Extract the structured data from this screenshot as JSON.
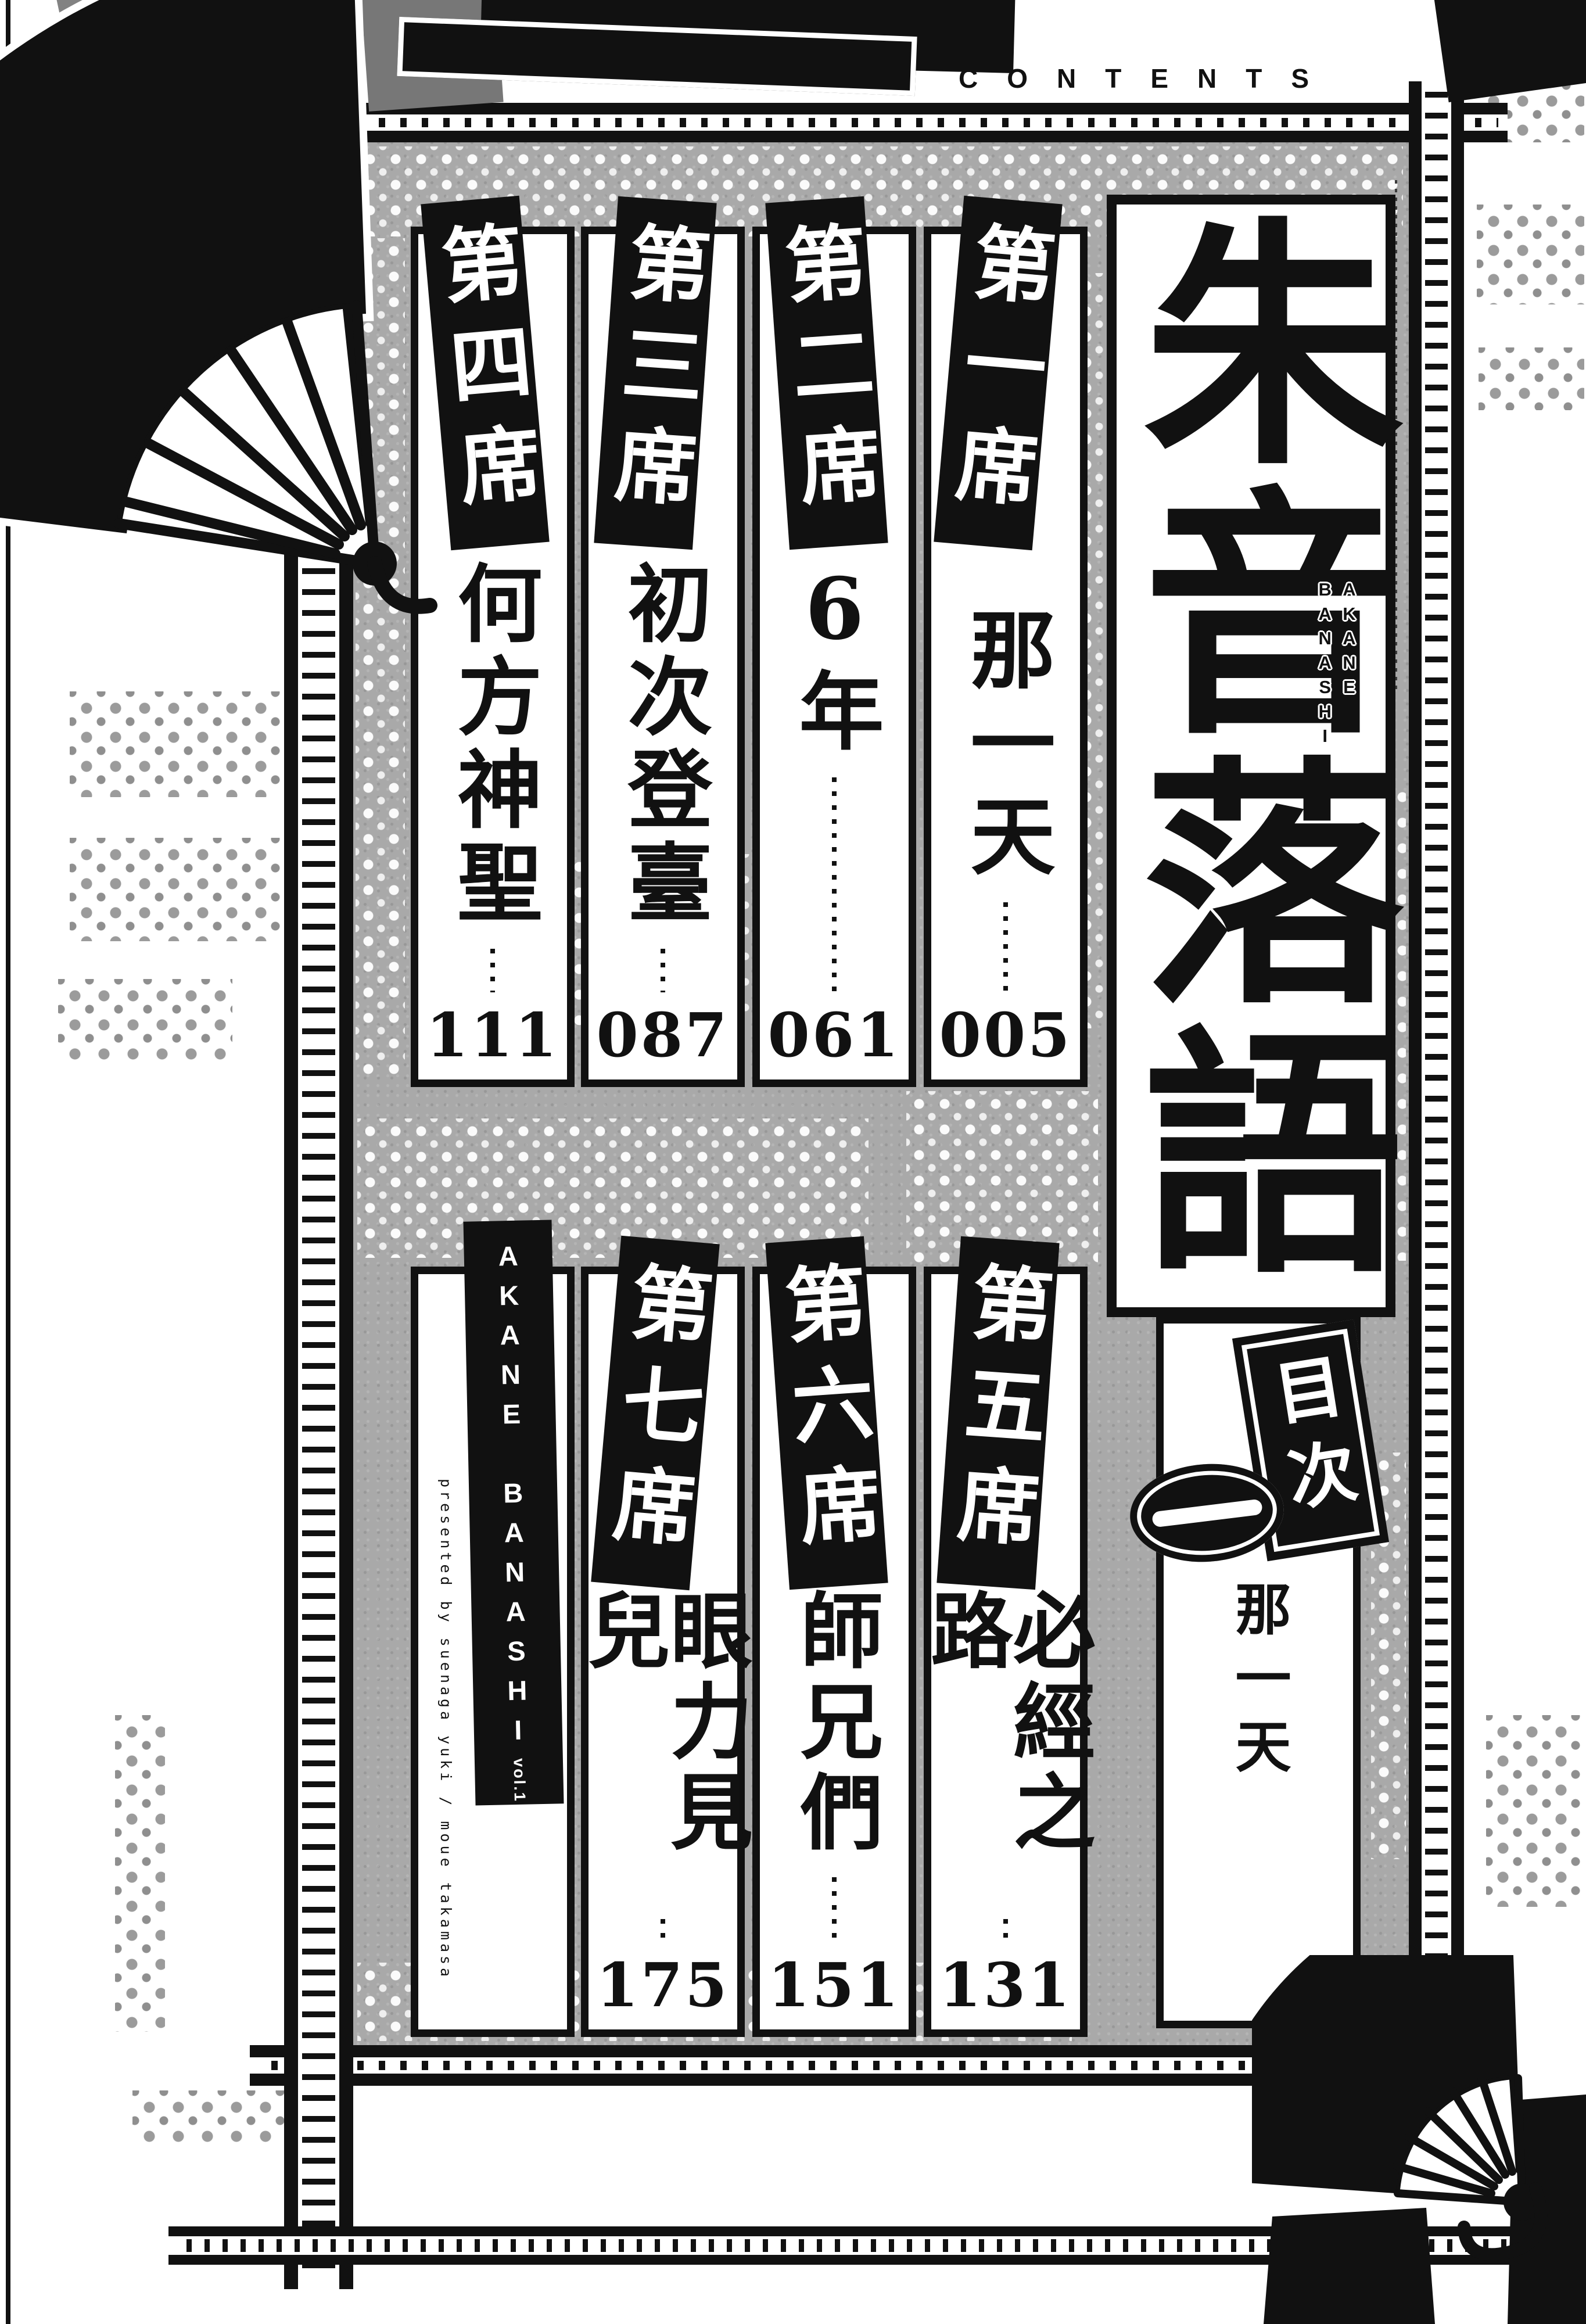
{
  "header": {
    "contents": "CONTENTS"
  },
  "title_block": {
    "title": "朱音落語",
    "romaji": [
      "AKANE",
      "BANASHI"
    ],
    "toc": "目次",
    "volume_mark": "一",
    "volume_subtitle": "那一天"
  },
  "chapters": [
    {
      "label": "第一席",
      "title": "那一天",
      "page": "005"
    },
    {
      "label": "第二席",
      "title": "6年",
      "page": "061"
    },
    {
      "label": "第三席",
      "title": "初次登臺",
      "page": "087"
    },
    {
      "label": "第四席",
      "title": "何方神聖",
      "page": "111"
    },
    {
      "label": "第五席",
      "title": "必經之路",
      "page": "131"
    },
    {
      "label": "第六席",
      "title": "師兄們",
      "page": "151"
    },
    {
      "label": "第七席",
      "title": "眼力見兒",
      "page": "175"
    }
  ],
  "credits": {
    "series": "AKANE BANASHI",
    "volume": "vol.1",
    "presented_by": "presented by suenaga yuki / moue takamasa"
  },
  "colors": {
    "ink": "#111111",
    "paper": "#ffffff",
    "background_gray": "#a9a9a9"
  }
}
